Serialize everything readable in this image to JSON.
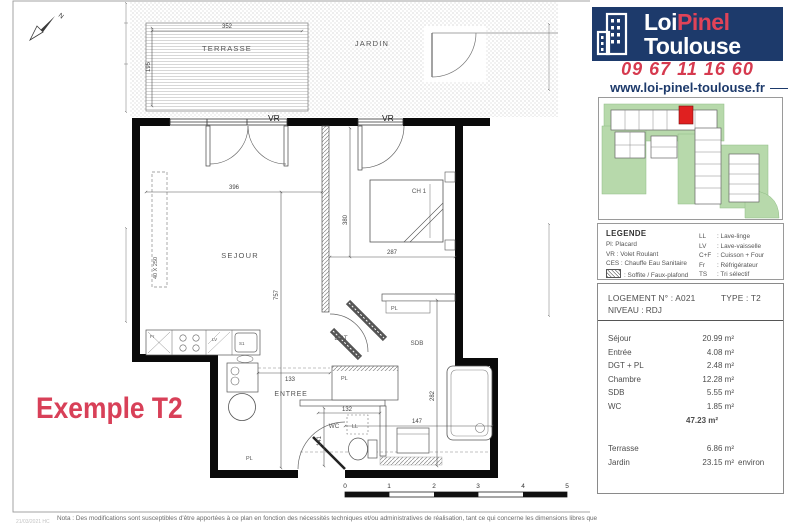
{
  "plan": {
    "watermark": "Exemple T2",
    "north": "N",
    "rooms": {
      "terrasse": "TERRASSE",
      "jardin": "JARDIN",
      "sejour": "SEJOUR",
      "entree": "ENTREE",
      "ch1": "CH 1",
      "sdb": "SDB",
      "dgt": "DGT",
      "wc": "WC"
    },
    "labels": {
      "vr": "VR",
      "pl": "PL",
      "ll": "LL",
      "fr": "Fr",
      "lv": "LV",
      "s1": "S1",
      "placard": "40 X 250"
    },
    "dims": {
      "t_w": "352",
      "t_h": "195",
      "s_w": "396",
      "s_h": "757",
      "c_h": "380",
      "c_w": "287",
      "e_w": "133",
      "wc_w": "132",
      "wc_h": "141",
      "sdb_w": "147",
      "sdb_h": "282"
    },
    "scale": [
      "0",
      "1",
      "2",
      "3",
      "4",
      "5"
    ]
  },
  "sidebar": {
    "logo": {
      "part1": "Loi",
      "part2": "Pinel",
      "line2": "Toulouse"
    },
    "phone": "09 67 11 16 60",
    "website": "www.loi-pinel-toulouse.fr",
    "colors": {
      "navy": "#1d3a6b",
      "red": "#d63a4f",
      "map_green": "#b7d9ab",
      "unit_red": "#e02020"
    },
    "legend": {
      "title": "LEGENDE",
      "left": [
        "Pl: Placard",
        "VR : Volet Roulant",
        "CES : Chauffe Eau Sanitaire",
        ": Soffite / Faux-plafond"
      ],
      "right": [
        {
          "abbr": "LL",
          "label": ": Lave-linge"
        },
        {
          "abbr": "LV",
          "label": ": Lave-vaisselle"
        },
        {
          "abbr": "C+F",
          "label": ": Cuisson + Four"
        },
        {
          "abbr": "Fr",
          "label": ": Réfrigérateur"
        },
        {
          "abbr": "TS",
          "label": ": Tri sélectif"
        }
      ]
    },
    "unit": {
      "header_left": "LOGEMENT N° : A021",
      "header_right": "TYPE : T2",
      "level": "NIVEAU : RDJ",
      "rows": [
        {
          "name": "Séjour",
          "area": "20.99 m²"
        },
        {
          "name": "Entrée",
          "area": "4.08 m²"
        },
        {
          "name": "DGT + PL",
          "area": "2.48 m²"
        },
        {
          "name": "Chambre",
          "area": "12.28 m²"
        },
        {
          "name": "SDB",
          "area": "5.55 m²"
        },
        {
          "name": "WC",
          "area": "1.85 m²"
        }
      ],
      "total": "47.23 m²",
      "extra_rows": [
        {
          "name": "Terrasse",
          "area": "6.86 m²",
          "suffix": ""
        },
        {
          "name": "Jardin",
          "area": "23.15 m²",
          "suffix": "environ"
        }
      ]
    }
  },
  "footer": {
    "note": "Nota : Des modifications sont susceptibles d'être apportées à ce plan en fonction des nécessités techniques et/ou administratives de réalisation, tant ce qui concerne les dimensions libres que",
    "ref": "21/03/2021 HC"
  }
}
